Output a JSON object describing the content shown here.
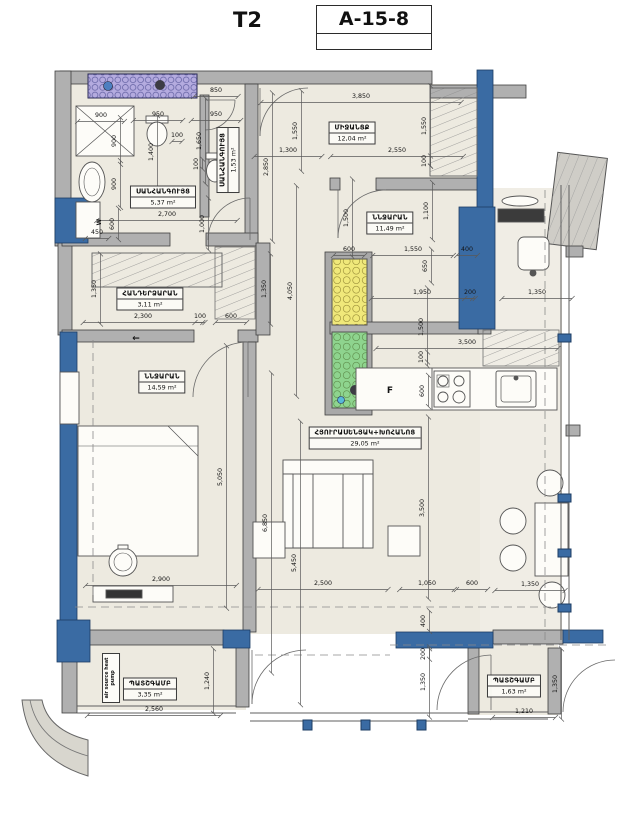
{
  "header": {
    "unit_label": "T2",
    "plan_code": "A-15-8"
  },
  "colors": {
    "wall_blue": "#3a6ba3",
    "wall_gray": "#b3b3b3",
    "room_fill": "#edeae0",
    "shaft_yellow": "#f0e87a",
    "shaft_green": "#8ed48e",
    "closet_lilac": "#b4abdf"
  },
  "rooms": [
    {
      "id": "bathroom-main",
      "name": "ՍԱՆՀԱՆԳՈՒՅՑ",
      "area": "5,37 m²",
      "x": 163,
      "y": 197,
      "vertical": false
    },
    {
      "id": "bathroom-small",
      "name": "ՍԱՆՀԱՆԳՈՒՅՑ",
      "area": "1,53 m²",
      "x": 228,
      "y": 160,
      "vertical": true
    },
    {
      "id": "hallway",
      "name": "ՄԻՋԱՆՑՔ",
      "area": "12,04 m²",
      "x": 352,
      "y": 133,
      "vertical": false
    },
    {
      "id": "bedroom-2",
      "name": "ՆՆՋԱՐԱՆ",
      "area": "11,49 m²",
      "x": 390,
      "y": 223,
      "vertical": false
    },
    {
      "id": "dressing",
      "name": "ՀԱՆԴԵՐՁԱՐԱՆ",
      "area": "3,11 m²",
      "x": 150,
      "y": 299,
      "vertical": false
    },
    {
      "id": "bedroom-1",
      "name": "ՆՆՋԱՐԱՆ",
      "area": "14,59 m²",
      "x": 162,
      "y": 382,
      "vertical": false
    },
    {
      "id": "living-kitchen",
      "name": "ՀՅՈՒՐԱՍԵՆՅԱԿ+ԽՈՀԱՆՈՑ",
      "area": "29,05 m²",
      "x": 365,
      "y": 438,
      "vertical": false
    },
    {
      "id": "balcony-left",
      "name": "ՊԱՏՇԳԱՄԲ",
      "area": "3,35 m²",
      "x": 150,
      "y": 689,
      "vertical": false
    },
    {
      "id": "balcony-right",
      "name": "ՊԱՏՇԳԱՄԲ",
      "area": "1,63 m²",
      "x": 514,
      "y": 686,
      "vertical": false
    }
  ],
  "equipment": {
    "heat_pump_label": "air source heat pump",
    "fridge_label": "F",
    "washer_label": "W"
  },
  "dimensions": [
    {
      "t": "850",
      "x": 216,
      "y": 92,
      "r": 0
    },
    {
      "t": "900",
      "x": 101,
      "y": 117,
      "r": 0
    },
    {
      "t": "950",
      "x": 158,
      "y": 116,
      "r": 0
    },
    {
      "t": "950",
      "x": 216,
      "y": 116,
      "r": 0
    },
    {
      "t": "100",
      "x": 177,
      "y": 137,
      "r": 0
    },
    {
      "t": "1,650",
      "x": 201,
      "y": 141,
      "r": 1
    },
    {
      "t": "1,400",
      "x": 153,
      "y": 152,
      "r": 1
    },
    {
      "t": "900",
      "x": 116,
      "y": 141,
      "r": 1
    },
    {
      "t": "900",
      "x": 116,
      "y": 184,
      "r": 1
    },
    {
      "t": "100",
      "x": 198,
      "y": 164,
      "r": 1
    },
    {
      "t": "2,700",
      "x": 167,
      "y": 216,
      "r": 0
    },
    {
      "t": "1,000",
      "x": 204,
      "y": 224,
      "r": 1
    },
    {
      "t": "600",
      "x": 114,
      "y": 224,
      "r": 1
    },
    {
      "t": "450",
      "x": 97,
      "y": 234,
      "r": 0
    },
    {
      "t": "1,300",
      "x": 288,
      "y": 152,
      "r": 0
    },
    {
      "t": "2,850",
      "x": 268,
      "y": 167,
      "r": 1
    },
    {
      "t": "2,550",
      "x": 397,
      "y": 152,
      "r": 0
    },
    {
      "t": "3,850",
      "x": 361,
      "y": 98,
      "r": 0
    },
    {
      "t": "1,550",
      "x": 297,
      "y": 131,
      "r": 1
    },
    {
      "t": "1,550",
      "x": 426,
      "y": 126,
      "r": 1
    },
    {
      "t": "100",
      "x": 426,
      "y": 161,
      "r": 1
    },
    {
      "t": "1,100",
      "x": 428,
      "y": 211,
      "r": 1
    },
    {
      "t": "1,500",
      "x": 348,
      "y": 218,
      "r": 1
    },
    {
      "t": "600",
      "x": 349,
      "y": 251,
      "r": 0
    },
    {
      "t": "1,550",
      "x": 413,
      "y": 251,
      "r": 0
    },
    {
      "t": "400",
      "x": 467,
      "y": 251,
      "r": 0
    },
    {
      "t": "650",
      "x": 427,
      "y": 266,
      "r": 1
    },
    {
      "t": "1,950",
      "x": 422,
      "y": 294,
      "r": 0
    },
    {
      "t": "200",
      "x": 470,
      "y": 294,
      "r": 0
    },
    {
      "t": "1,350",
      "x": 537,
      "y": 294,
      "r": 0
    },
    {
      "t": "1,500",
      "x": 423,
      "y": 327,
      "r": 1
    },
    {
      "t": "100",
      "x": 423,
      "y": 357,
      "r": 1
    },
    {
      "t": "600",
      "x": 424,
      "y": 391,
      "r": 1
    },
    {
      "t": "3,500",
      "x": 467,
      "y": 344,
      "r": 0
    },
    {
      "t": "1,350",
      "x": 96,
      "y": 289,
      "r": 1
    },
    {
      "t": "2,300",
      "x": 143,
      "y": 318,
      "r": 0
    },
    {
      "t": "100",
      "x": 200,
      "y": 318,
      "r": 0
    },
    {
      "t": "600",
      "x": 231,
      "y": 318,
      "r": 0
    },
    {
      "t": "1,350",
      "x": 266,
      "y": 289,
      "r": 1
    },
    {
      "t": "4,050",
      "x": 292,
      "y": 291,
      "r": 1
    },
    {
      "t": "5,050",
      "x": 222,
      "y": 477,
      "r": 1
    },
    {
      "t": "6,850",
      "x": 267,
      "y": 523,
      "r": 1
    },
    {
      "t": "5,450",
      "x": 296,
      "y": 563,
      "r": 1
    },
    {
      "t": "3,500",
      "x": 424,
      "y": 508,
      "r": 1
    },
    {
      "t": "2,900",
      "x": 161,
      "y": 581,
      "r": 0
    },
    {
      "t": "2,500",
      "x": 323,
      "y": 585,
      "r": 0
    },
    {
      "t": "1,050",
      "x": 427,
      "y": 585,
      "r": 0
    },
    {
      "t": "600",
      "x": 472,
      "y": 585,
      "r": 0
    },
    {
      "t": "1,350",
      "x": 530,
      "y": 586,
      "r": 0
    },
    {
      "t": "400",
      "x": 425,
      "y": 621,
      "r": 1
    },
    {
      "t": "200",
      "x": 425,
      "y": 654,
      "r": 1
    },
    {
      "t": "1,350",
      "x": 425,
      "y": 682,
      "r": 1
    },
    {
      "t": "1,240",
      "x": 209,
      "y": 681,
      "r": 1
    },
    {
      "t": "2,560",
      "x": 154,
      "y": 711,
      "r": 0
    },
    {
      "t": "1,210",
      "x": 524,
      "y": 713,
      "r": 0
    },
    {
      "t": "1,350",
      "x": 557,
      "y": 684,
      "r": 1
    },
    {
      "t": "F",
      "x": 390,
      "y": 393,
      "r": 0,
      "nl": 1,
      "s": 9
    },
    {
      "t": "W",
      "x": 101,
      "y": 222,
      "r": 1,
      "nl": 1,
      "s": 6
    },
    {
      "t": "←",
      "x": 136,
      "y": 341,
      "r": 0,
      "nl": 1,
      "s": 9
    }
  ]
}
